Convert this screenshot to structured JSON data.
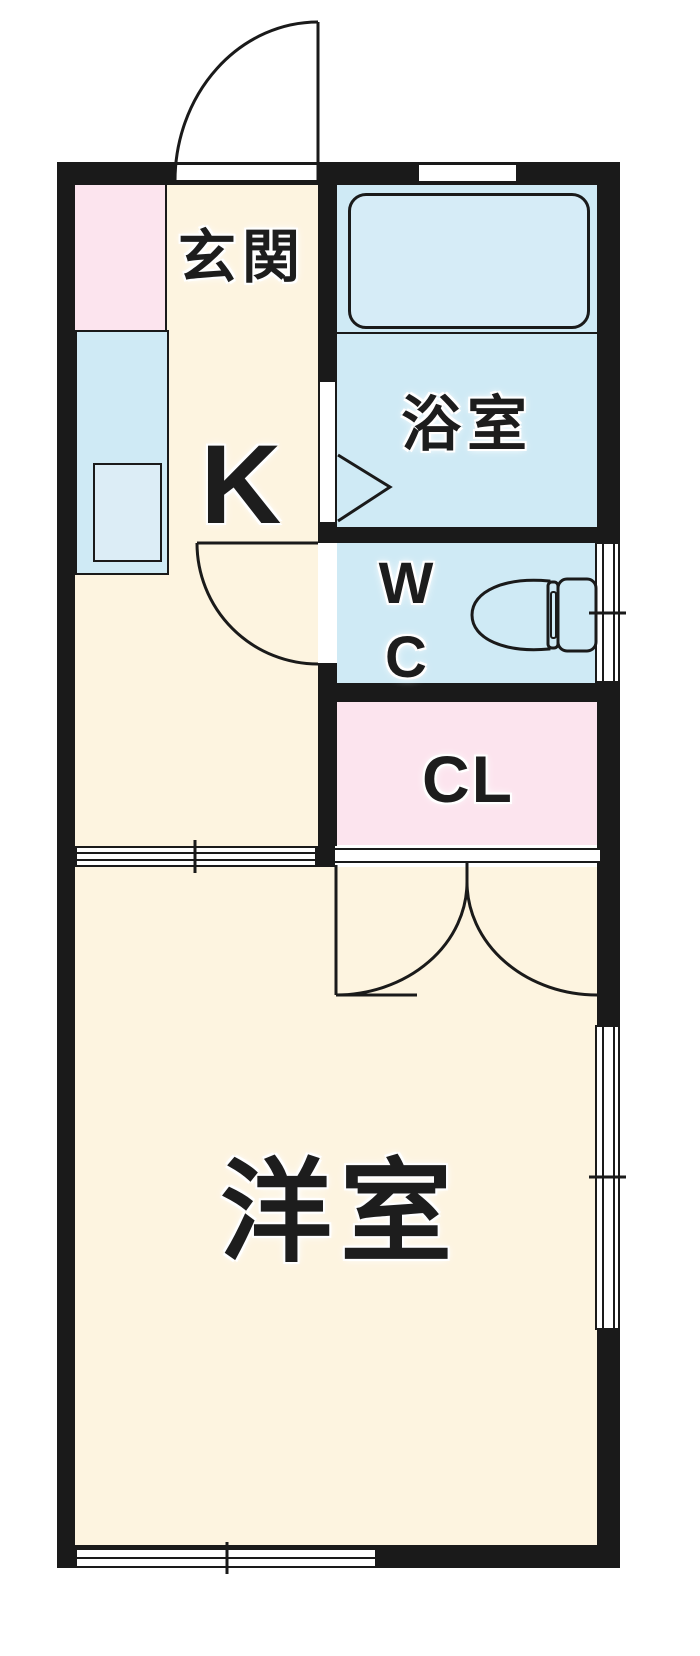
{
  "colors": {
    "bg": "#ffffff",
    "wall": "#1a1a1a",
    "line": "#1a1a1a",
    "floor-beige": "#fdf4e0",
    "wet-blue": "#cfeaf5",
    "tub-blue": "#d6ecf7",
    "sink-blue": "#dcedf6",
    "pink": "#fce4ee",
    "label": "#1d1d1d",
    "halo": "#ffffff"
  },
  "rooms": {
    "genkan": {
      "label": "玄関"
    },
    "kitchen": {
      "label": "K"
    },
    "bathroom": {
      "label": "浴室"
    },
    "wc": {
      "line1": "W",
      "line2": "C"
    },
    "closet": {
      "label": "CL"
    },
    "western_room": {
      "label": "洋室"
    }
  }
}
